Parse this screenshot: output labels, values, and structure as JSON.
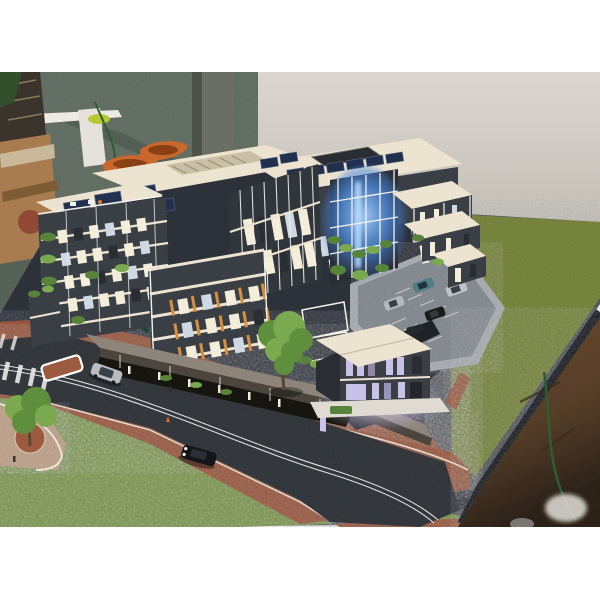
{
  "scene": {
    "type": "photograph",
    "subject": "Architectural scale model of a modern mixed-use apartment complex displayed on a dark presentation baseboard",
    "setting": "model-maker workshop: mottled concrete floor, plain beige wall, concrete column, cardboard box and orange moulded hulls in the background",
    "caption": "Scale model of apartment development with roads, lawns, rooftop solar panels, lit interiors and a blue-lit atrium"
  },
  "palette": {
    "wall": "#cbc6be",
    "wall_top": "#dad6cf",
    "floor": "#667267",
    "floor_dark": "#49544b",
    "pillar": "#6a6e64",
    "box": "#a87c4e",
    "box_shade": "#7d5c35",
    "boat": "#c8682d",
    "base_navy": "#2d313a",
    "base_edge": "#171a20",
    "road": "#35393f",
    "road_line": "#e9e9e6",
    "brick": "#9c5a41",
    "curb": "#ece4d4",
    "grass_right": "#7e8c41",
    "grass_front": "#7c9b46",
    "deck": "#8a8f95",
    "deck_wall": "#a4a9ae",
    "cream": "#ece4d0",
    "cream_shade": "#d9d0ba",
    "charcoal": "#3a3e45",
    "charcoal_dark": "#2a2d33",
    "solar": "#20304d",
    "win_warm": "#f3edda",
    "win_cool": "#cfd9e4",
    "win_lav": "#c9c1e8",
    "fin_orange": "#d68f3e",
    "mullion": "#f2f1ec",
    "plant": "#57833b",
    "plant_light": "#7aa94f",
    "canopy": "#8e857a",
    "canopy_dark": "#4b453e",
    "tree": "#5f8f3d",
    "trunk": "#5a4631",
    "brown_floor": "#64452e",
    "cable": "#2e5d33"
  },
  "objects": {
    "buildings": [
      {
        "name": "left apartment tower",
        "feature": "charcoal facade, cream floor slabs, planted balconies, rooftop terrace with solar panels"
      },
      {
        "name": "central block",
        "feature": "rooftop louvre enclosure and solar arrays, white mullioned glazing"
      },
      {
        "name": "rear block",
        "feature": "cream roof with rows of dark solar panels around a courtyard opening"
      },
      {
        "name": "glazed atrium",
        "feature": "white frame grid with blue interior lighting and cascading planting"
      },
      {
        "name": "terrace houses",
        "feature": "stepped cream canopies on white posts"
      },
      {
        "name": "mid-rise with orange fins",
        "feature": "amber timber batten screens on balconies"
      },
      {
        "name": "retail podium",
        "feature": "street canopy over lit shopfronts"
      },
      {
        "name": "corner pavilion",
        "feature": "two-storey, cream flat roof, lavender-lit glazing"
      }
    ],
    "site": [
      "asphalt roads with double white centrelines",
      "red paver footpaths with white kerbs",
      "artificial grass lawns",
      "roof-deck car park with marked stalls and ramp",
      "pedestrian crossing",
      "red traffic island",
      "street trees",
      "tiny pedestrians and traffic cone"
    ],
    "cars": [
      {
        "location": "side road",
        "color": "#b9bdc1"
      },
      {
        "location": "main road",
        "color": "#141517"
      },
      {
        "location": "car park",
        "color": "#4f7d86"
      },
      {
        "location": "car park",
        "color": "#c0c3c6"
      },
      {
        "location": "car park",
        "color": "#b5b9bd"
      },
      {
        "location": "car park",
        "color": "#1a1b1d"
      },
      {
        "location": "ramp",
        "color": "#25282c"
      }
    ],
    "background_items": [
      "taped cardboard box",
      "wrapped timber post",
      "white foam-board offcuts",
      "two orange moulded hulls",
      "green cable",
      "concrete column",
      "rusty floor patch lower right"
    ]
  }
}
